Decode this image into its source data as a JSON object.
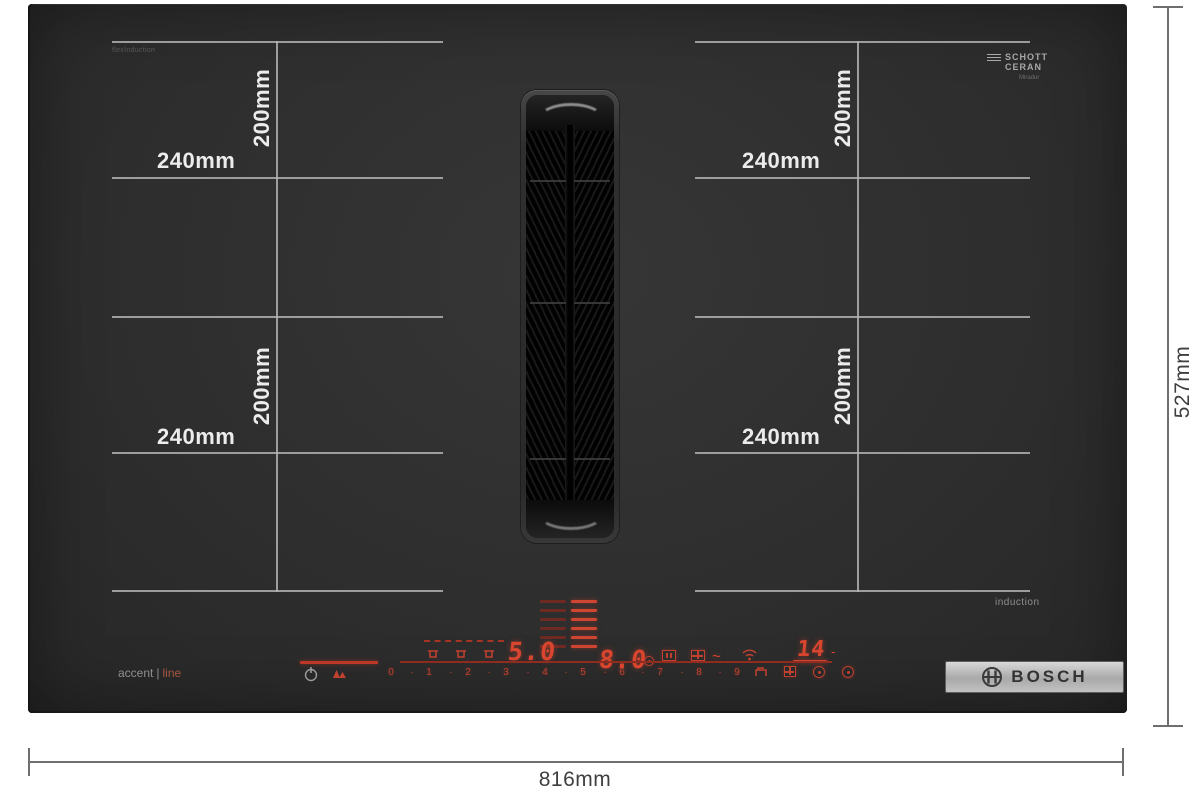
{
  "annotations": {
    "overall_width": "816mm",
    "overall_height": "527mm",
    "zone_width": "240mm",
    "zone_height": "200mm"
  },
  "branding": {
    "bosch": "BOSCH",
    "schott_line1": "SCHOTT",
    "schott_line2": "CERAN",
    "schott_sub": "Miradur",
    "series_left": "accent",
    "series_divider": "|",
    "series_right": "line",
    "corner_marking": "flexInduction",
    "induction_marking": "induction"
  },
  "controls": {
    "display_left": "5.0",
    "display_center": "8.0",
    "display_timer": "14",
    "timer_dash": "-",
    "wave": "~",
    "slider_dot": "·",
    "slider_numbers": [
      "0",
      "1",
      "2",
      "3",
      "4",
      "5",
      "6",
      "7",
      "8",
      "9"
    ]
  },
  "icons": {
    "power": "power-icon (standby circle)",
    "child_lock": "double-triangle-icon",
    "pan_detect": "pan-icon x3",
    "fan_level_dim": "fan-bars-dim-column",
    "fan_level_bright": "fan-bars-bright-column",
    "clock_small": "clock-icon",
    "frame": "frame-icon",
    "grid": "grid-icon",
    "wifi": "wifi-icon",
    "bridge": "bridge-zone-icon",
    "timer_a": "timer-icon",
    "timer_b": "timer-icon",
    "bosch_anchor": "bosch-anchor-icon"
  },
  "colors": {
    "panel": "#2e2e2e",
    "zone_line": "#b6b6b6",
    "annotation_line": "#6e6e6e",
    "led_red": "#d9452e",
    "label_white": "#ececec",
    "plate_metal": "#b9b9b9"
  }
}
